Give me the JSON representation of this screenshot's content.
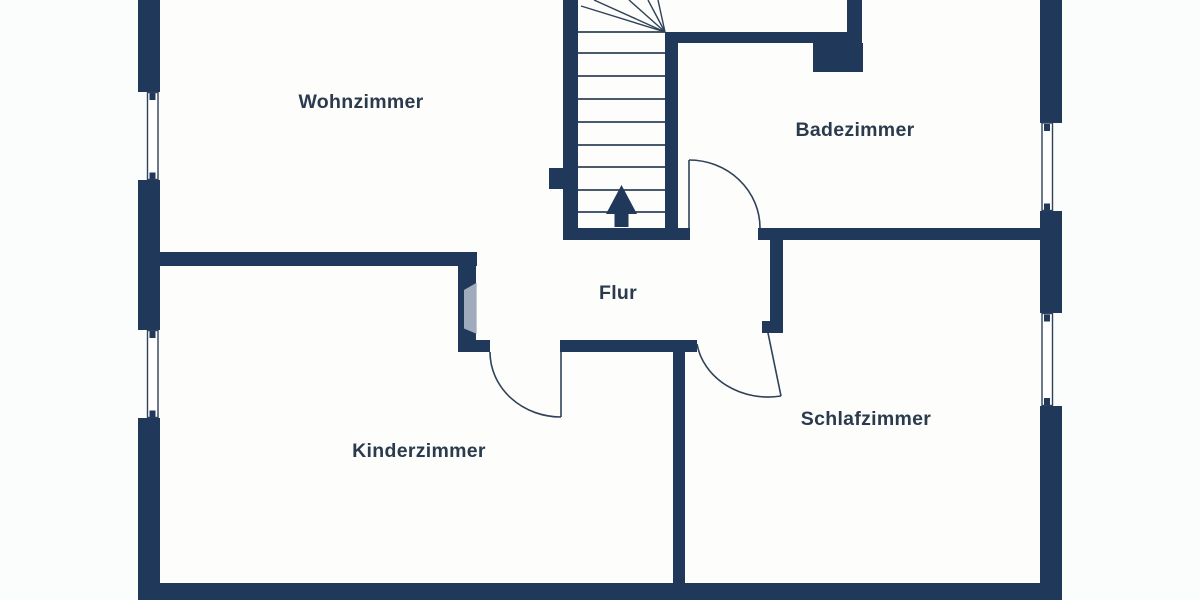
{
  "rooms": [
    {
      "name": "wohnzimmer",
      "label": "Wohnzimmer"
    },
    {
      "name": "badezimmer",
      "label": "Badezimmer"
    },
    {
      "name": "flur",
      "label": "Flur"
    },
    {
      "name": "kinderzimmer",
      "label": "Kinderzimmer"
    },
    {
      "name": "schlafzimmer",
      "label": "Schlafzimmer"
    }
  ],
  "stairs": {
    "direction_icon": "up-arrow"
  },
  "doors": [
    {
      "room": "Badezimmer",
      "swing": "into-room, hinge-left"
    },
    {
      "room": "Kinderzimmer",
      "swing": "into-room, hinge-right"
    },
    {
      "room": "Schlafzimmer",
      "swing": "into-room, hinge-top"
    }
  ],
  "windows": {
    "left_wall": 2,
    "right_wall": 2
  },
  "colors": {
    "wall": "#20395a",
    "room_fill": "#fdfdfc",
    "background": "#fbfcfc",
    "label_text": "#2b3a4d",
    "line": "#2f4257",
    "watermark": "#b7c1cd"
  }
}
